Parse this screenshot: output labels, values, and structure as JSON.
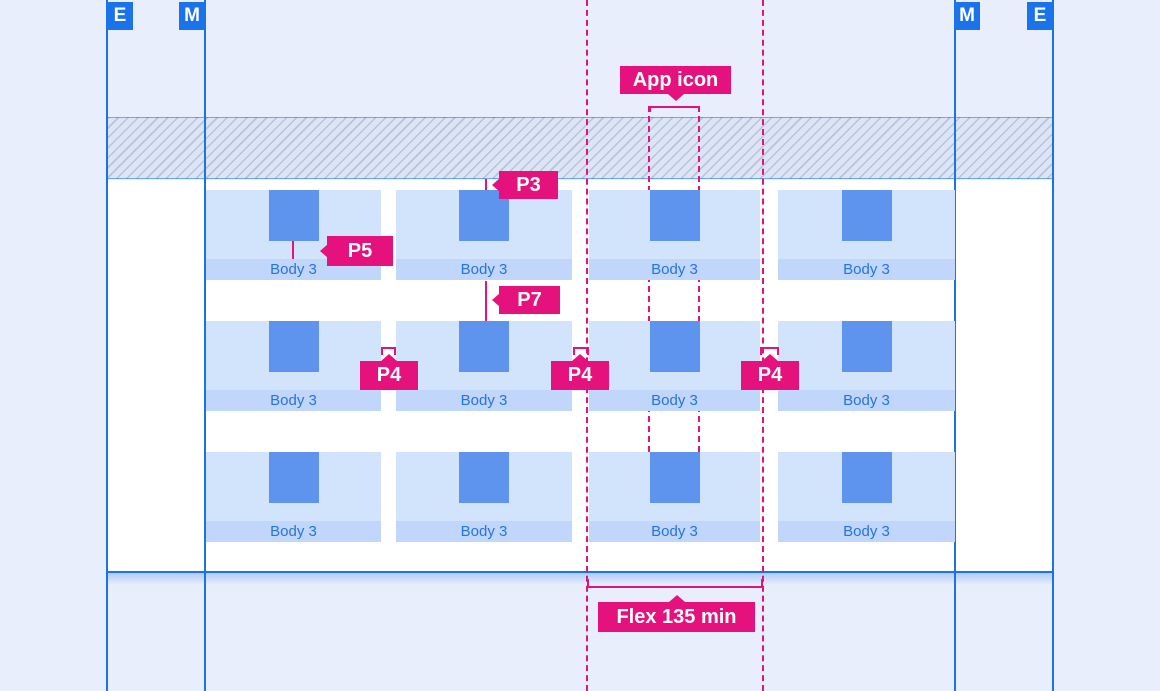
{
  "diagram": {
    "markers": {
      "left_outer": "E",
      "left_inner": "M",
      "right_inner": "M",
      "right_outer": "E"
    },
    "cells": {
      "label": "Body 3",
      "columns": 4,
      "rows": 3
    },
    "annotations": {
      "app_icon": "App icon",
      "p3": "P3",
      "p5": "P5",
      "p7": "P7",
      "p4_left": "P4",
      "p4_middle": "P4",
      "p4_right": "P4",
      "flex_min": "Flex 135 min"
    },
    "colors": {
      "background": "#e8eefc",
      "accent_blue": "#1a73e8",
      "accent_pink": "#e5127e",
      "cell_fill": "#d2e3fc",
      "cell_caption_fill": "#c0d6fa",
      "icon_fill": "#5f94ee",
      "caption_text": "#2673e2"
    }
  }
}
